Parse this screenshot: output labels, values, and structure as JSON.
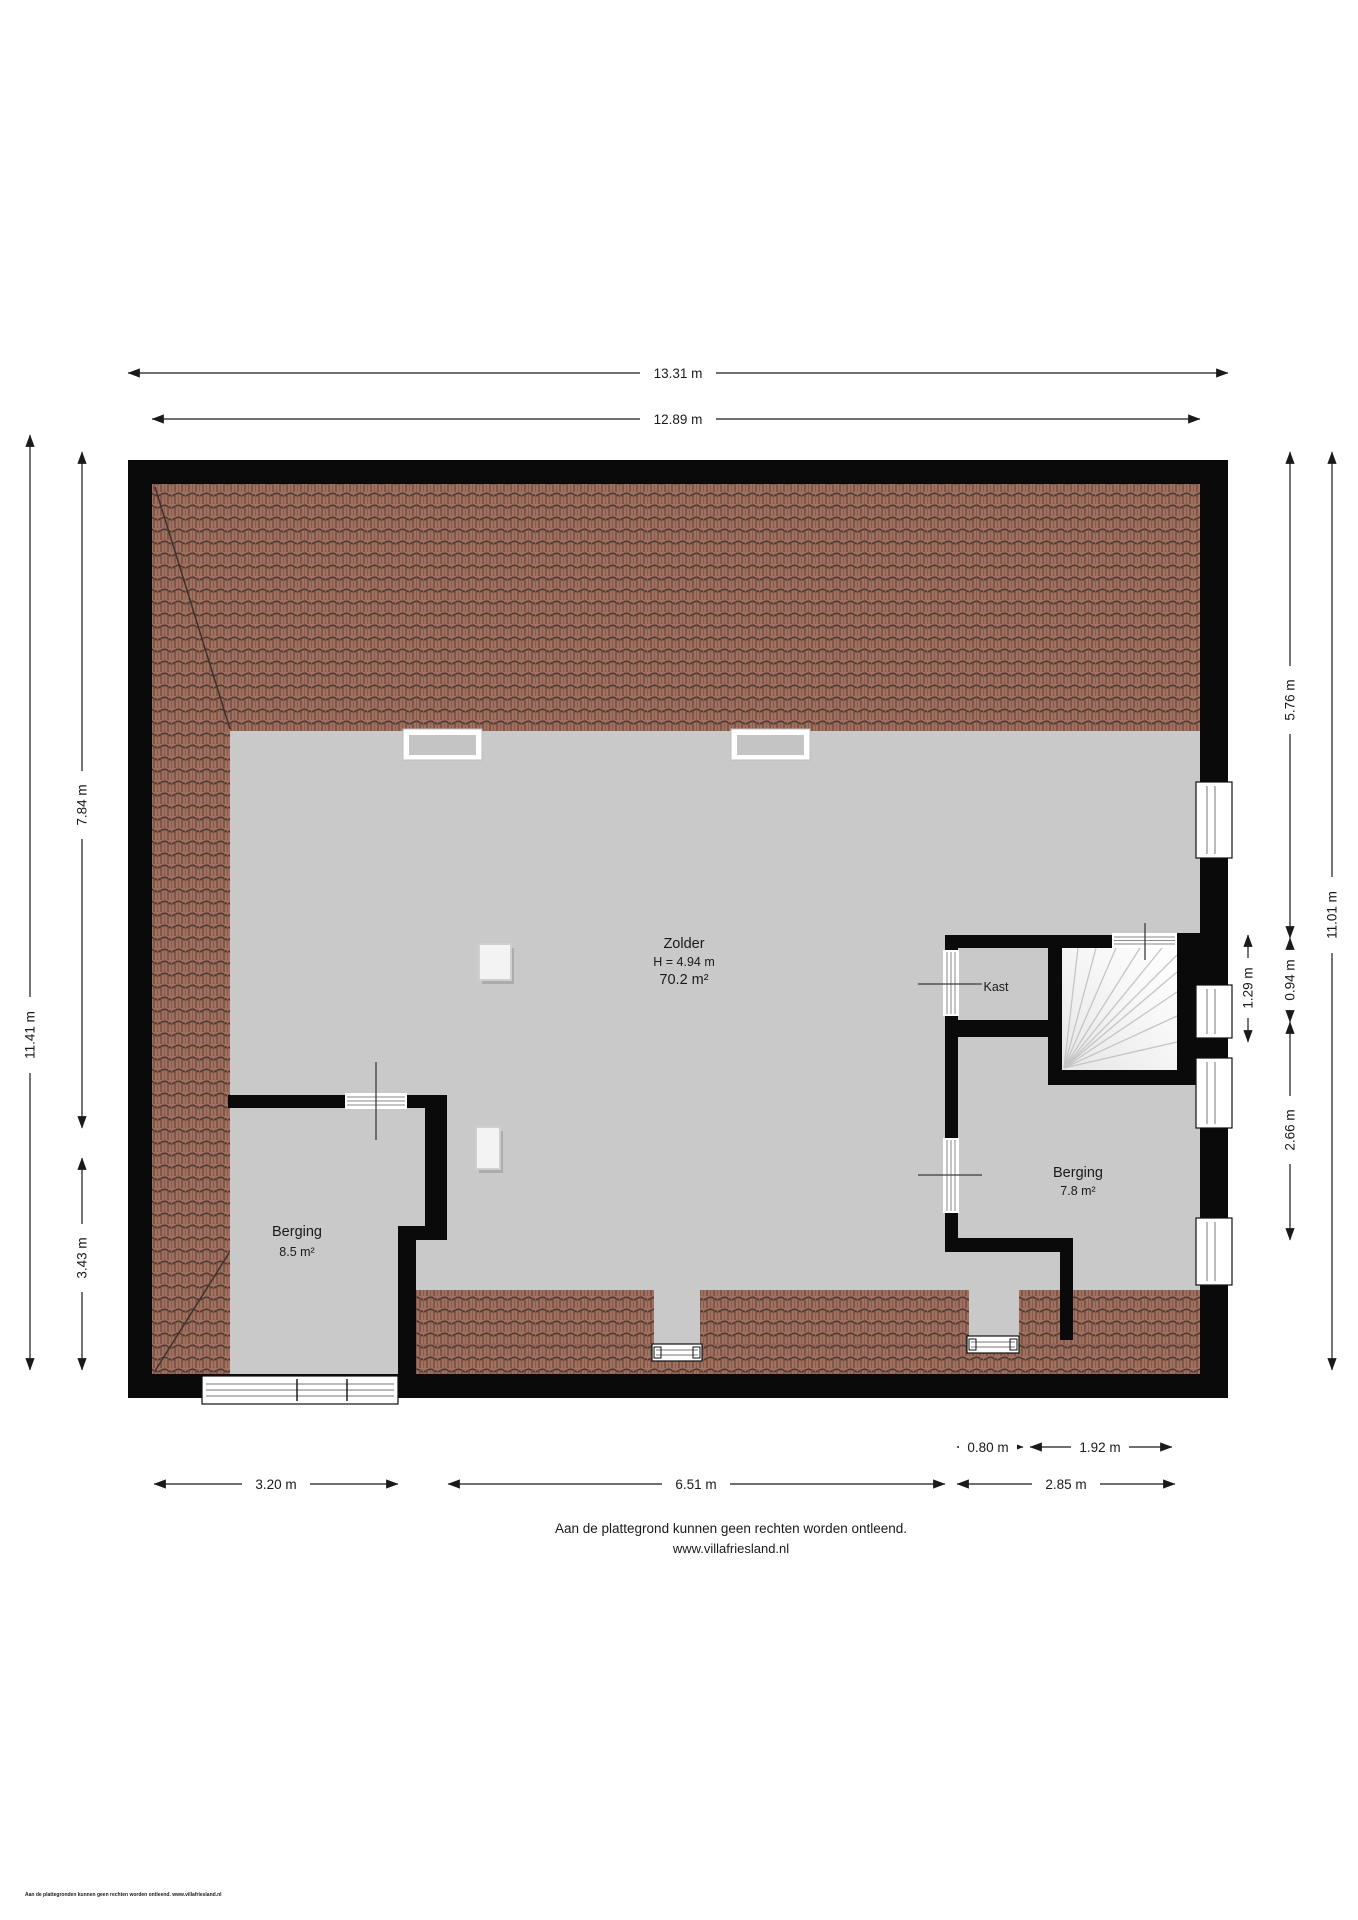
{
  "page": {
    "disclaimer": "Aan de plattegrond kunnen geen rechten worden ontleend.",
    "website": "www.villafriesland.nl",
    "footer_small": "Aan de plattegronden kunnen geen rechten worden ontleend. www.villafriesland.nl"
  },
  "rooms": {
    "zolder": {
      "name": "Zolder",
      "height": "H = 4.94 m",
      "area": "70.2 m²"
    },
    "kast": {
      "name": "Kast"
    },
    "berging_left": {
      "name": "Berging",
      "area": "8.5 m²"
    },
    "berging_right": {
      "name": "Berging",
      "area": "7.8 m²"
    }
  },
  "dimensions": {
    "top_outer": "13.31 m",
    "top_inner": "12.89 m",
    "left_total": "11.41 m",
    "left_upper": "7.84 m",
    "left_lower": "3.43 m",
    "right_total": "11.01 m",
    "right_upper": "5.76 m",
    "right_stair_inner": "0.94 m",
    "right_stair_outer": "1.29 m",
    "right_lower": "2.66 m",
    "bottom_kast": "0.80 m",
    "bottom_stairs": "1.92 m",
    "bottom_left": "3.20 m",
    "bottom_middle": "6.51 m",
    "bottom_right": "2.85 m"
  },
  "colors": {
    "wall": "#0a0a0a",
    "floor": "#c9c9c9",
    "roof_tile": "#a2705f",
    "roof_line_dark": "#4f3b34",
    "dimension_text": "#1a1a1a"
  }
}
